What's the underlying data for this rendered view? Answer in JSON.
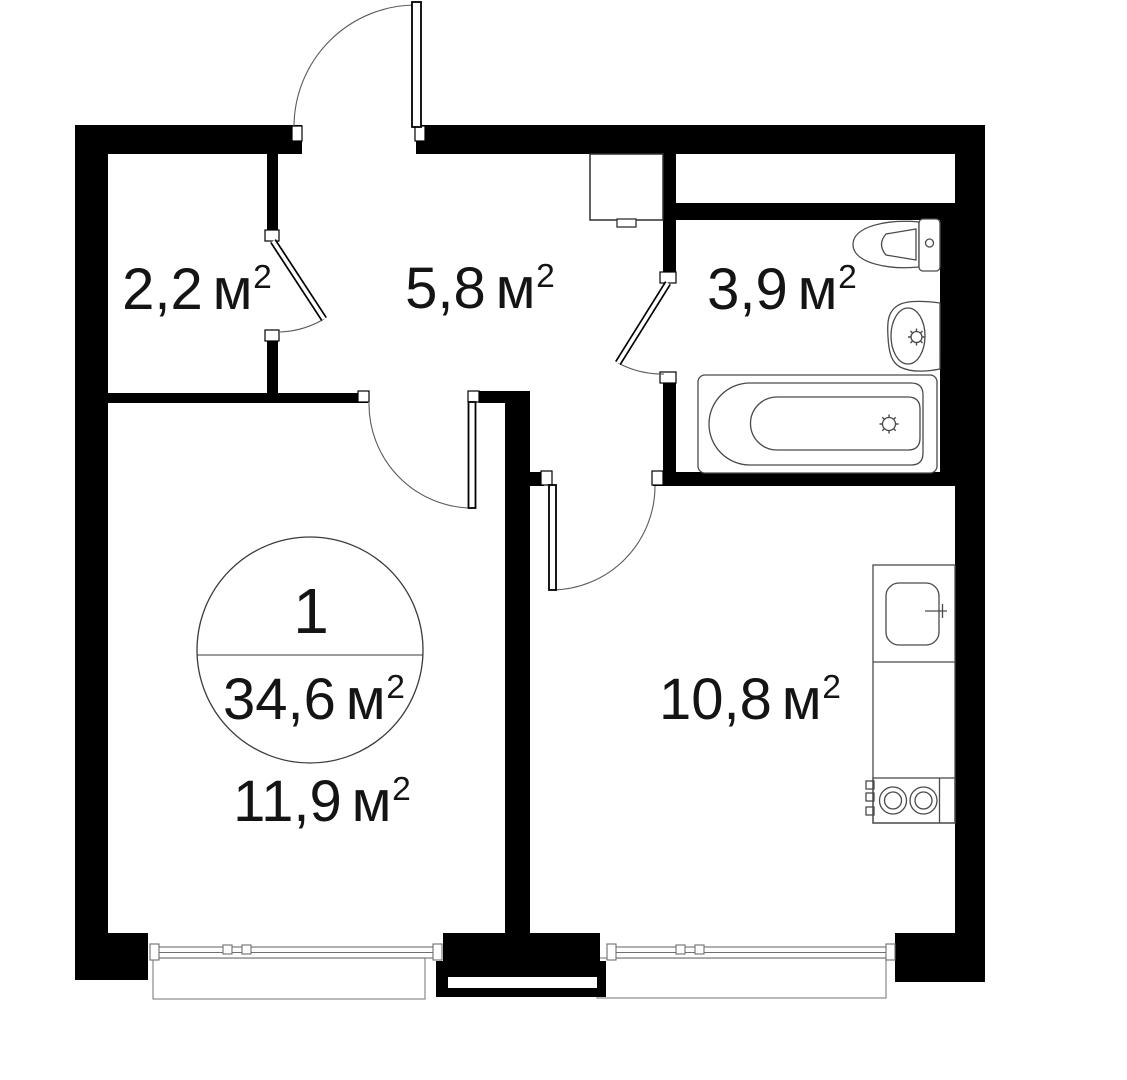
{
  "badge": {
    "rooms_count": "1",
    "area_value": "34,6",
    "area_unit": "м",
    "area_sup": "2"
  },
  "rooms": {
    "storage": {
      "area_value": "2,2",
      "area_unit": "м",
      "area_sup": "2"
    },
    "hallway": {
      "area_value": "5,8",
      "area_unit": "м",
      "area_sup": "2"
    },
    "bathroom": {
      "area_value": "3,9",
      "area_unit": "м",
      "area_sup": "2"
    },
    "kitchen": {
      "area_value": "10,8",
      "area_unit": "м",
      "area_sup": "2"
    },
    "bedroom": {
      "area_value": "11,9",
      "area_unit": "м",
      "area_sup": "2"
    }
  },
  "colors": {
    "wall": "#000000",
    "fixture_line": "#4a4a4a",
    "background": "#ffffff",
    "text": "#141414"
  }
}
